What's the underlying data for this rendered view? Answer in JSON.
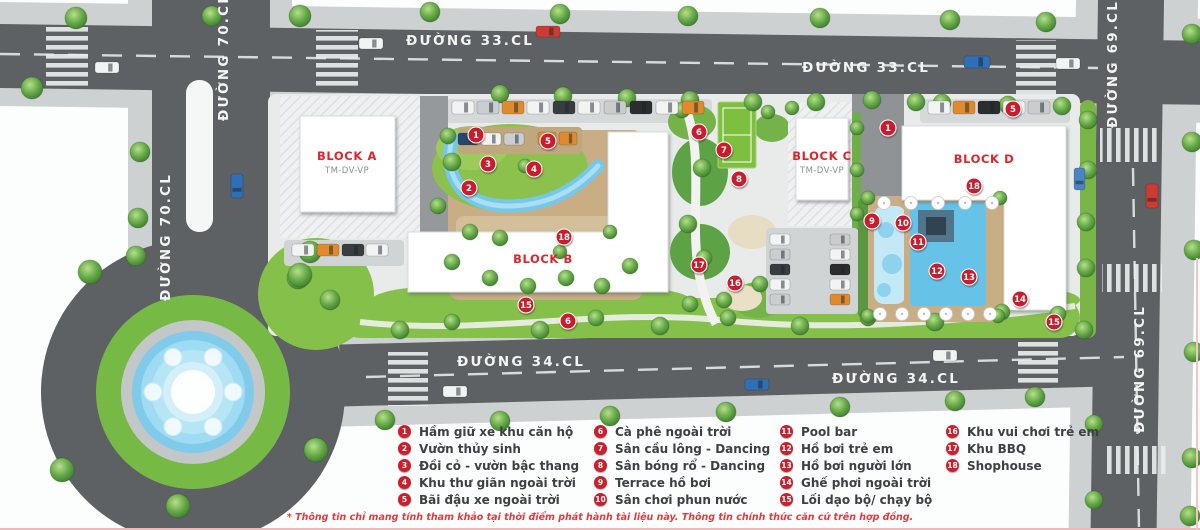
{
  "palette": {
    "road": "#5d6164",
    "sidewalk": "#cdd1d2",
    "lawn": "#85c04b",
    "pool": "#66c2e7",
    "deck": "#c9ad85",
    "marker_red": "#cb1f2d",
    "label_red": "#e0242b",
    "building": "#ffffff"
  },
  "roads": [
    {
      "id": "duong70-top",
      "text": "ĐƯỜNG 70.CL",
      "x": 228,
      "y": 57,
      "vertical": true
    },
    {
      "id": "duong70-mid",
      "text": "ĐƯỜNG 70.CL",
      "x": 170,
      "y": 237,
      "vertical": true
    },
    {
      "id": "duong33-left",
      "text": "ĐƯỜNG 33.CL",
      "x": 470,
      "y": 45,
      "vertical": false
    },
    {
      "id": "duong33-right",
      "text": "ĐƯỜNG 33.CL",
      "x": 866,
      "y": 72,
      "vertical": false
    },
    {
      "id": "duong69-top",
      "text": "ĐƯỜNG 69.CL",
      "x": 1117,
      "y": 64,
      "vertical": true
    },
    {
      "id": "duong69-bottom",
      "text": "ĐƯỜNG 69.CL",
      "x": 1144,
      "y": 369,
      "vertical": true
    },
    {
      "id": "duong34-left",
      "text": "ĐƯỜNG 34.CL",
      "x": 521,
      "y": 366,
      "vertical": false
    },
    {
      "id": "duong34-right",
      "text": "ĐƯỜNG 34.CL",
      "x": 896,
      "y": 383,
      "vertical": false
    }
  ],
  "blocks": [
    {
      "name": "BLOCK A",
      "sub": "TM-DV-VP",
      "x": 347,
      "y": 160
    },
    {
      "name": "BLOCK B",
      "sub": "",
      "x": 543,
      "y": 263
    },
    {
      "name": "BLOCK C",
      "sub": "TM-DV-VP",
      "x": 822,
      "y": 160
    },
    {
      "name": "BLOCK D",
      "sub": "",
      "x": 984,
      "y": 163
    }
  ],
  "markers": [
    {
      "n": "1",
      "x": 476,
      "y": 135
    },
    {
      "n": "3",
      "x": 488,
      "y": 164
    },
    {
      "n": "2",
      "x": 469,
      "y": 188
    },
    {
      "n": "4",
      "x": 534,
      "y": 169
    },
    {
      "n": "5",
      "x": 548,
      "y": 141
    },
    {
      "n": "18",
      "x": 564,
      "y": 237
    },
    {
      "n": "15",
      "x": 526,
      "y": 305
    },
    {
      "n": "6",
      "x": 568,
      "y": 321
    },
    {
      "n": "6",
      "x": 699,
      "y": 132
    },
    {
      "n": "7",
      "x": 724,
      "y": 150
    },
    {
      "n": "8",
      "x": 739,
      "y": 179
    },
    {
      "n": "17",
      "x": 699,
      "y": 265
    },
    {
      "n": "16",
      "x": 735,
      "y": 283
    },
    {
      "n": "1",
      "x": 888,
      "y": 128
    },
    {
      "n": "5",
      "x": 1013,
      "y": 109
    },
    {
      "n": "18",
      "x": 974,
      "y": 186
    },
    {
      "n": "9",
      "x": 872,
      "y": 221
    },
    {
      "n": "10",
      "x": 903,
      "y": 223
    },
    {
      "n": "11",
      "x": 918,
      "y": 242
    },
    {
      "n": "12",
      "x": 937,
      "y": 271
    },
    {
      "n": "13",
      "x": 969,
      "y": 277
    },
    {
      "n": "14",
      "x": 1020,
      "y": 299
    },
    {
      "n": "15",
      "x": 1054,
      "y": 322
    }
  ],
  "legend": {
    "items": [
      {
        "n": "1",
        "label": "Hầm giữ xe khu căn hộ"
      },
      {
        "n": "2",
        "label": "Vườn thủy sinh"
      },
      {
        "n": "3",
        "label": "Đồi cỏ - vườn bậc thang"
      },
      {
        "n": "4",
        "label": "Khu thư giãn ngoài trời"
      },
      {
        "n": "5",
        "label": "Bãi đậu xe ngoài trời"
      },
      {
        "n": "6",
        "label": "Cà phê ngoài trời"
      },
      {
        "n": "7",
        "label": "Sân cầu lông - Dancing"
      },
      {
        "n": "8",
        "label": "Sân bóng rổ - Dancing"
      },
      {
        "n": "9",
        "label": "Terrace hồ bơi"
      },
      {
        "n": "10",
        "label": "Sân chơi phun nước"
      },
      {
        "n": "11",
        "label": "Pool bar"
      },
      {
        "n": "12",
        "label": "Hồ bơi trẻ em"
      },
      {
        "n": "13",
        "label": "Hồ bơi người lớn"
      },
      {
        "n": "14",
        "label": "Ghế phơi ngoài trời"
      },
      {
        "n": "15",
        "label": "Lối dạo bộ/ chạy bộ"
      },
      {
        "n": "16",
        "label": "Khu vui chơi trẻ em"
      },
      {
        "n": "17",
        "label": "Khu BBQ"
      },
      {
        "n": "18",
        "label": "Shophouse"
      }
    ]
  },
  "footnote": "* Thông tin chỉ mang tính tham khảo tại thời điểm phát hành tài liệu này. Thông tin chính thức căn cứ trên hợp đồng."
}
